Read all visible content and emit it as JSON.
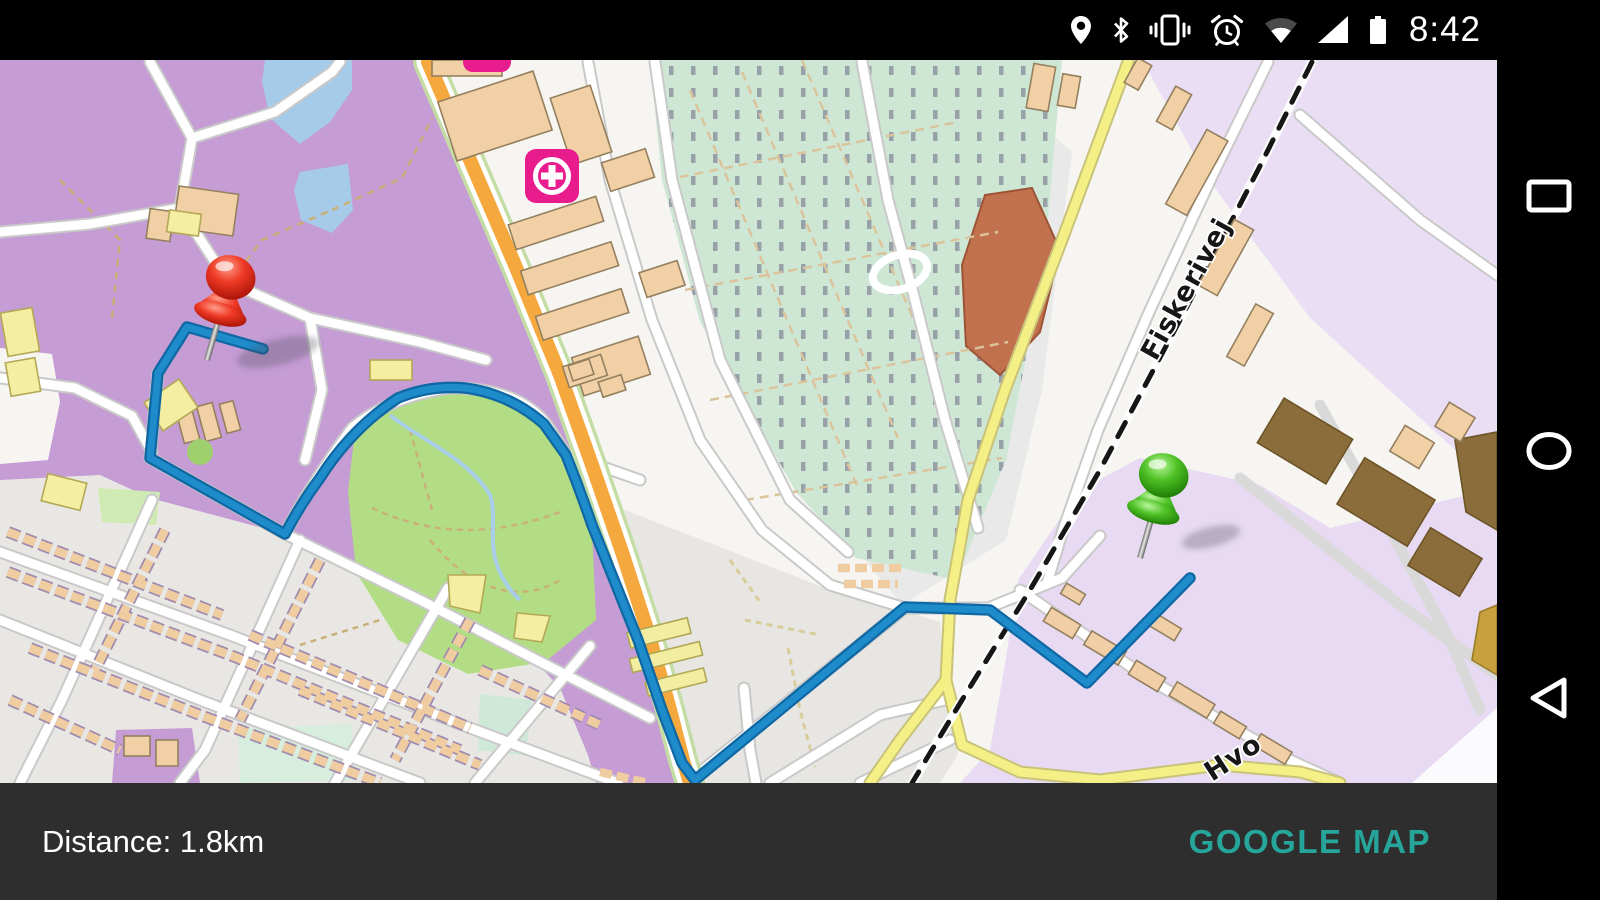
{
  "status_bar": {
    "time": "8:42",
    "background": "#000000",
    "icons": [
      "location-pin",
      "bluetooth",
      "vibrate",
      "alarm-clock",
      "wifi",
      "cell-signal",
      "battery"
    ]
  },
  "navigation_bar": {
    "background": "#000000",
    "buttons": [
      "recent-apps",
      "home",
      "back"
    ]
  },
  "bottom_bar": {
    "background": "#2e2e2e",
    "distance_label": "Distance: 1.8km",
    "action_button": "GOOGLE MAP",
    "action_color": "#26a69a"
  },
  "map": {
    "style": "openstreetmap",
    "street_labels": {
      "fiskerivej": {
        "text": "Fiskerivej",
        "transform": "translate(1156,302) rotate(-61)"
      },
      "hvo": {
        "text": "Hvo",
        "transform": "translate(1212,722) rotate(-33)"
      }
    },
    "route": {
      "color": "#1e8ccb",
      "casing_color": "#0f67a3",
      "path": "M263,289 L187,267 L158,313 L150,398 L285,474 Q300,445 320,418 Q352,368 398,338 Q430,325 465,328 Q510,334 544,364 L566,395 Q580,430 592,465 L638,580 L662,650 L682,703 L695,720 L905,547 L990,550 L1087,623 L1190,518"
    },
    "pins": {
      "start": {
        "color": "red",
        "transform": "translate(207,300)"
      },
      "end": {
        "color": "green",
        "transform": "translate(1140,498)"
      }
    },
    "hospital_icon_color": "#e81c8c"
  }
}
